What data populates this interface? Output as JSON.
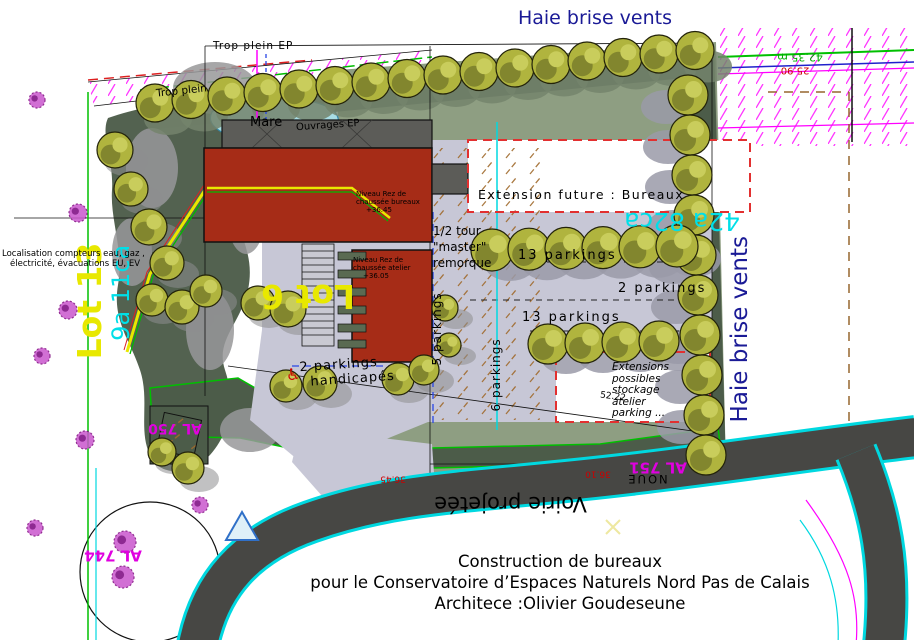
{
  "plan": {
    "hedge_top_label": "Haie brise vents",
    "hedge_right_label": "Haie brise vents",
    "extension_future_label": "Extension future :  Bureaux",
    "parkings_row1_label": "13 parkings",
    "parkings_row2_label": "2 parkings",
    "parkings_row3_label": "13 parkings",
    "parkings_west_label": "5 parkings",
    "parkings_south_label": "6 parkings",
    "handicap_line1": "2 parkings",
    "handicap_line2": "handicapés",
    "half_turn_lines": [
      "1/2 tour",
      "\"master\"",
      "remorque"
    ],
    "extensions_possibles_lines": [
      "Extensions",
      "possibles",
      "stockage",
      "atelier",
      "parking ..."
    ],
    "lot_west_label": "Lot 13",
    "lot_center_label": "Lot 6",
    "area_east_label": "42a 82ca",
    "area_west_label": "9a 11ca",
    "road_label": "Voirie projetée",
    "noue_label": "NOUE",
    "mare_label": "Mare",
    "trop_plein_ep_label": "Trop plein  EP",
    "trop_plein_label": "Trop plein",
    "ouvrages_ep_label": "Ouvrages EP",
    "utilities_line1": "Localisation compteurs eau, gaz ,",
    "utilities_line2": "électricité, évacuations EU, EV",
    "parcel_al750": "AL 750",
    "parcel_al744": "AL 744",
    "parcel_al751": "AL 751",
    "level_bureaux_lines": [
      "Niveau Rez de",
      "chaussée bureaux",
      "+36.45"
    ],
    "level_atelier_lines": [
      "Niveau Rez de",
      "chaussée atelier",
      "+36.05"
    ],
    "dim_boundary_east": "42.35 m",
    "dim_25_90": "25.90",
    "level_36_45": "36.45",
    "level_36_10": "36.10",
    "dim_diag": "52.22"
  },
  "title_block": {
    "line1": "Construction de bureaux",
    "line2": "pour le Conservatoire d’Espaces Naturels  Nord Pas de Calais",
    "line3": "Architece :Olivier Goudeseune"
  },
  "icons": {
    "wheelchair": "♿"
  },
  "colors": {
    "hedge_text": "#1a1a96",
    "lot_text": "#e8e800",
    "area_text": "#00dfe8",
    "parcel_text": "#e000e0",
    "dim_green": "#00aa00",
    "dim_red": "#cc0000",
    "building": "#a62c17",
    "parking": "#c7c7d6",
    "sage": "#8e9e82",
    "hedge_dark": "#4c5c49",
    "tree": "#b0b43e",
    "road": "#474744"
  }
}
